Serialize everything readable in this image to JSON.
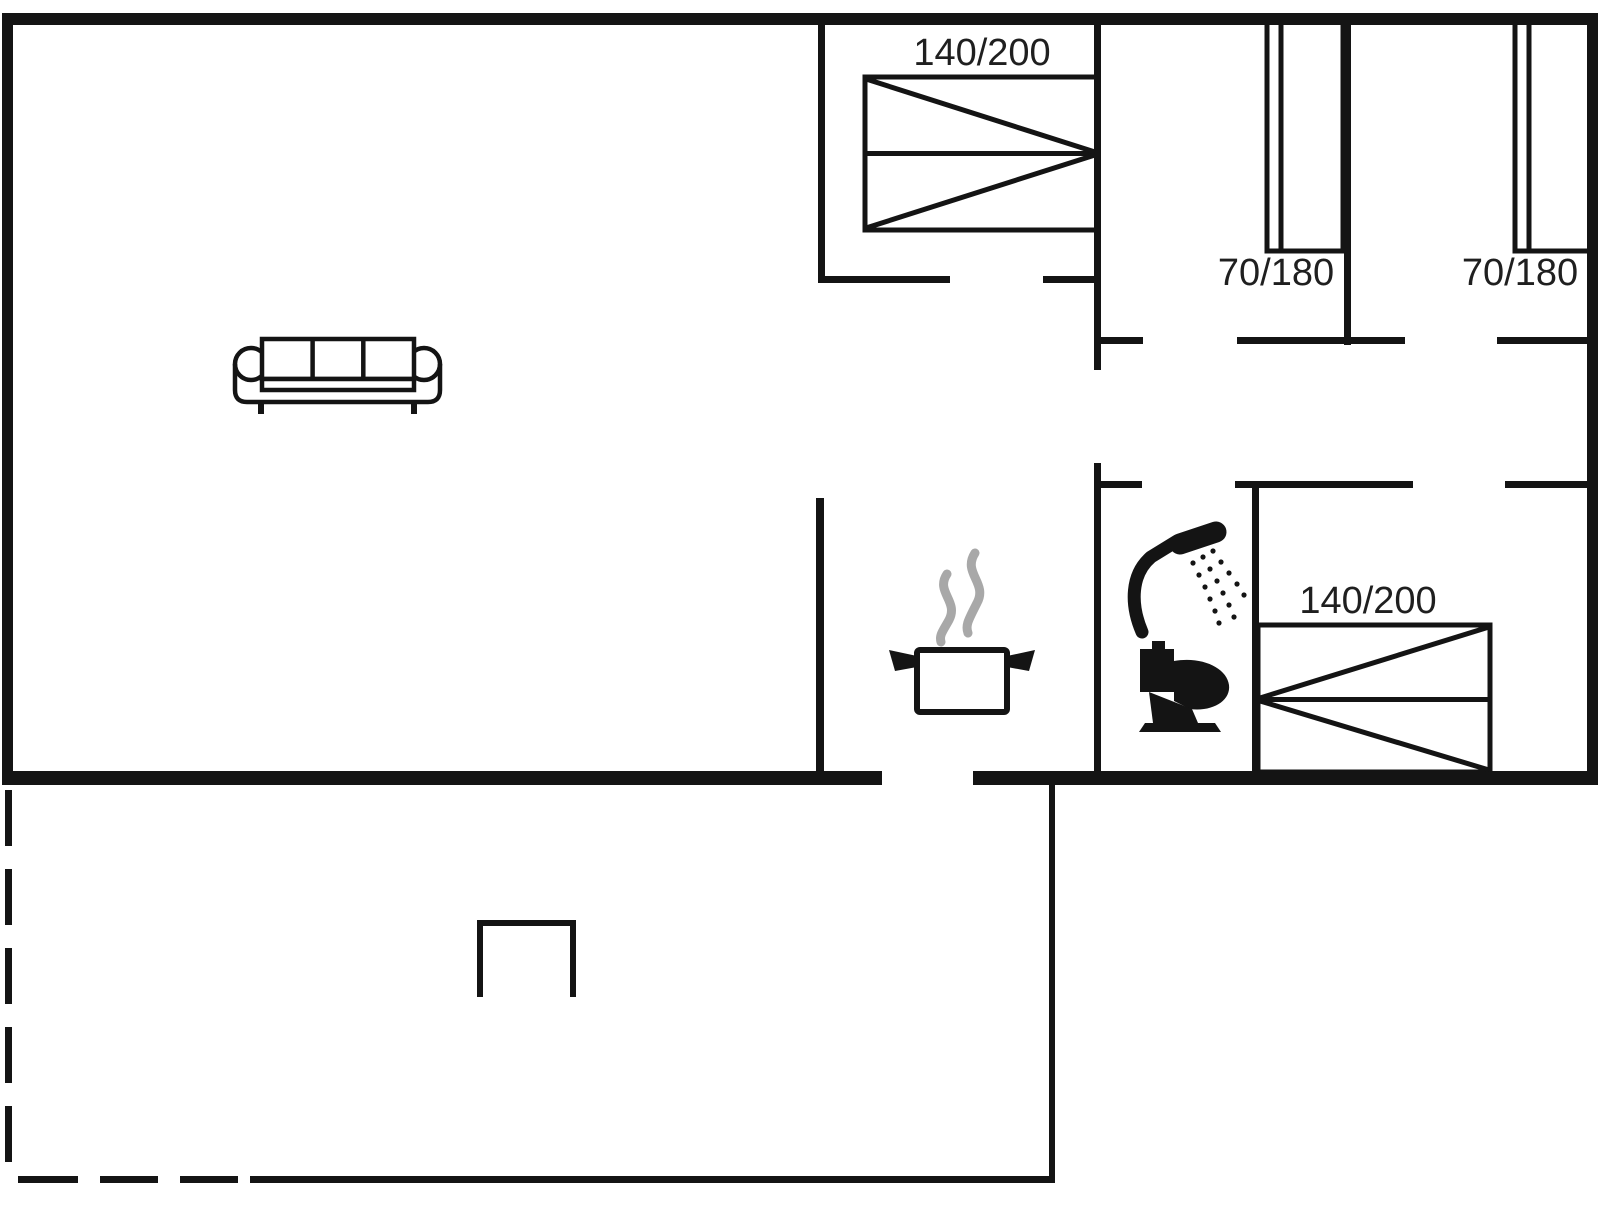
{
  "floor_plan": {
    "colors": {
      "wall": "#141414",
      "steam": "#a8a8a8",
      "label_text": "#1f1f1f",
      "background": "#ffffff"
    },
    "labels": {
      "bedroom_top_bed_size": "140/200",
      "small_room_left_bed_size": "70/180",
      "small_room_right_bed_size": "70/180",
      "bedroom_right_bed_size": "140/200"
    },
    "icons": [
      "sofa-icon",
      "double-bed-icon",
      "single-bed-icon",
      "steam-icon",
      "cooking-pot-icon",
      "shower-icon",
      "toilet-icon",
      "terrace-step-icon"
    ]
  }
}
